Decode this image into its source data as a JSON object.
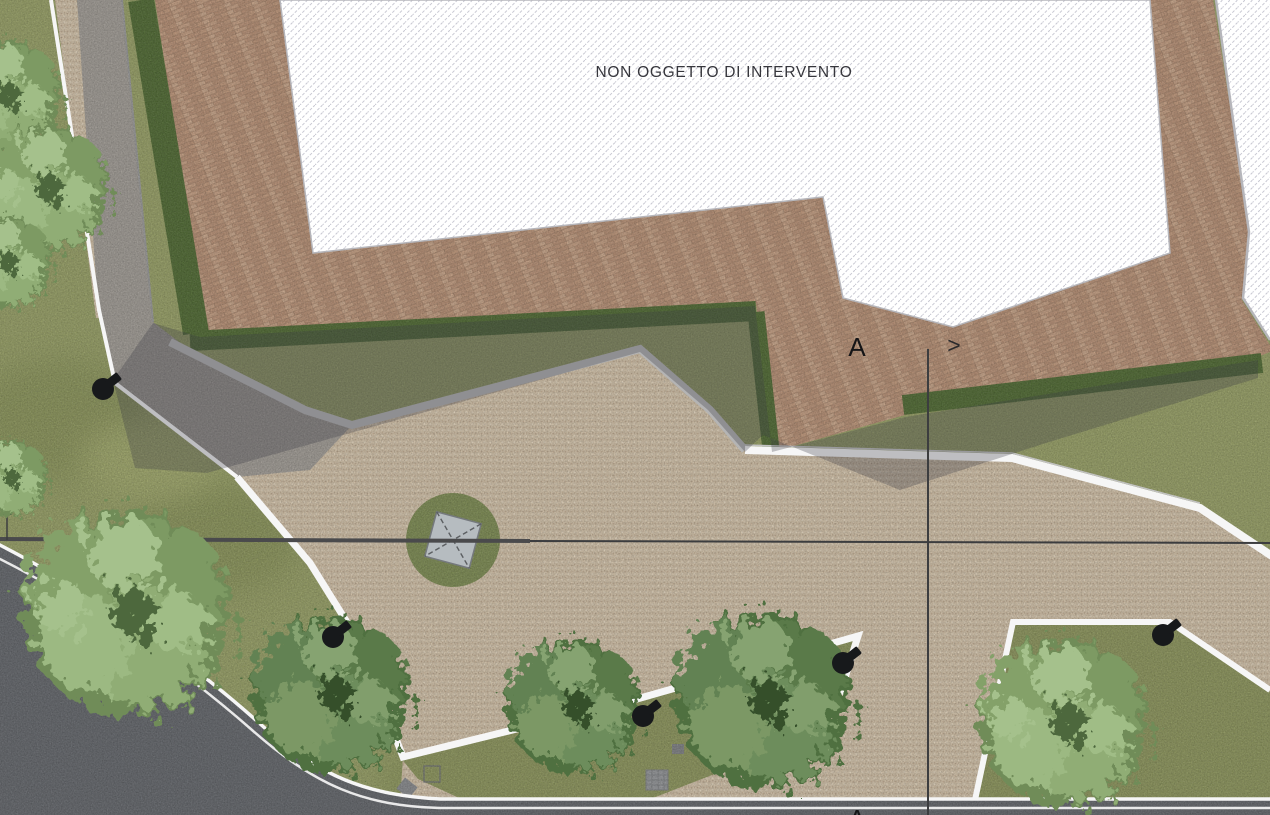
{
  "labels": {
    "non_intervention_area": "NON OGGETTO DI INTERVENTO",
    "section_letter_top": "A",
    "section_letter_bottom": "A",
    "section_direction_glyph": ">"
  },
  "palette": {
    "grass": "#99a266",
    "grass_shade": "#7f8a50",
    "planting_bed": "#8e975c",
    "plaza_gravel": "#d6c5ab",
    "pebble_dark": "#c3ad92",
    "pebble_light": "#e4d6bf",
    "path_paving": "#a39e97",
    "road_asphalt": "#64676c",
    "brick_base": "#a8846a",
    "brick_light": "#c8a184",
    "brick_mid": "#b99074",
    "hedge": "#4f6a31",
    "curb_white": "#f6f6f6",
    "curb_gray": "#b4b4b4",
    "hatch_line": "#c8c8d2",
    "hatch_background": "#ffffff",
    "building_shadow": "rgba(60,60,70,0.30)",
    "island_lawn": "#7e8d52",
    "pavilion_roof": "#b6bcc0",
    "tree_canopy_light": "#8fae77",
    "tree_canopy_dark": "#5d7d52",
    "street_lamp": "#17191b",
    "utility_cover": "#8a8c8f",
    "section_line": "#3c3d3f"
  },
  "symbols": {
    "street_lamp_icon": "black circle with arm",
    "utility_cover_icon": "gray square",
    "tree_icon": "green canopy blob",
    "section_arrow_icon": "chevron right",
    "north_tick_icon": "small up arrow"
  },
  "features": {
    "street_lamp_count": 5,
    "tree_count": 9,
    "planting_bed_count": 2
  }
}
